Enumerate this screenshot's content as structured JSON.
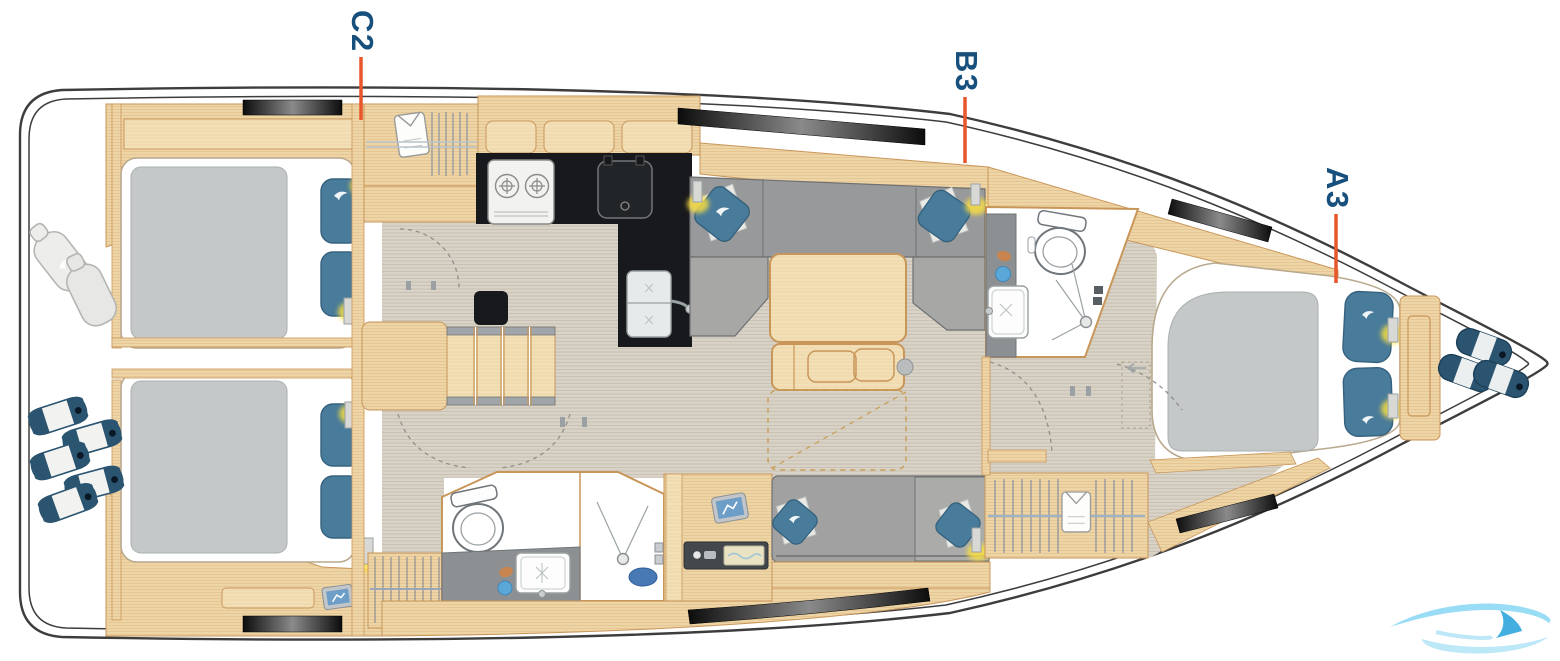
{
  "diagram": {
    "title_hint": "sailing-yacht interior layout plan, top view, bow to the right",
    "labels": {
      "c2": {
        "text": "C2"
      },
      "b3": {
        "text": "B3"
      },
      "a3": {
        "text": "A3"
      }
    },
    "colors": {
      "label_text": "#17507c",
      "pointer_line": "#e8562c",
      "hull_outline": "#3d3d3d",
      "wood": "#eed5a6",
      "wood_light": "#f3e0b6",
      "wood_edge": "#c9965a",
      "floor": "#d9d2c6",
      "upholstery_gray": "#a0a1a0",
      "sofa_back_gray": "#98999b",
      "mattress_gray": "#c4c8c8",
      "pillow_blue": "#497b9a",
      "fender_navy": "#2a5470",
      "galley_counter_black": "#17191c",
      "bath_counter_gray": "#8d9092",
      "lamp_glow_yellow": "#ffe23e",
      "watermark_blue": "#8ed9f4"
    },
    "watermark": {
      "icon": "wave-logo"
    }
  }
}
